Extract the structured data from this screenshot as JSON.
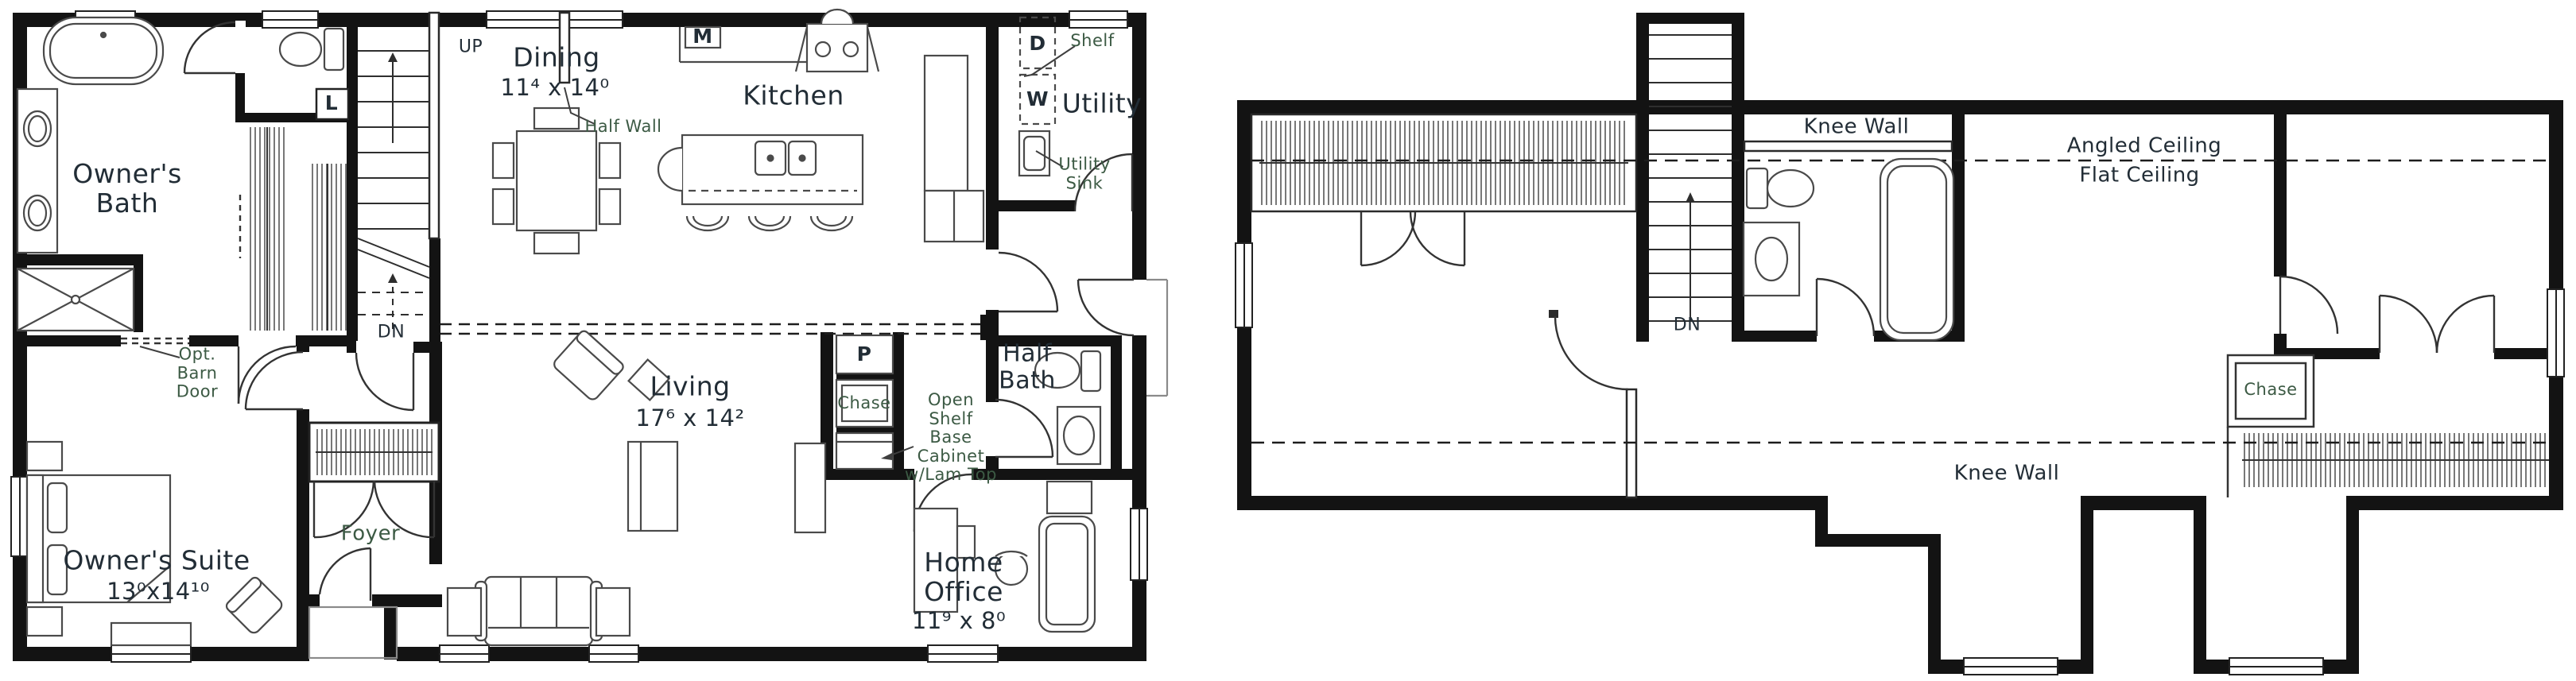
{
  "title": "Two-story house floor plan",
  "colors": {
    "wall": "#131313",
    "line": "#4a4a4a",
    "text_dark": "#222d36",
    "text_green": "#3c5a44",
    "background": "#ffffff"
  },
  "floor1": {
    "rooms": {
      "owners_bath": {
        "name": "Owner's\nBath"
      },
      "dining": {
        "name": "Dining",
        "dims": "11⁴ x 14⁰"
      },
      "kitchen": {
        "name": "Kitchen"
      },
      "utility": {
        "name": "Utility"
      },
      "living": {
        "name": "Living",
        "dims": "17⁶ x 14²"
      },
      "owners_suite": {
        "name": "Owner's Suite",
        "dims": "13⁰x14¹⁰"
      },
      "foyer": {
        "name": "Foyer"
      },
      "half_bath": {
        "name": "Half\nBath"
      },
      "home_office": {
        "name": "Home\nOffice",
        "dims": "11⁹ x 8⁰"
      }
    },
    "annotations": {
      "up": "UP",
      "dn": "DN",
      "linen": "L",
      "microwave": "M",
      "dryer": "D",
      "washer": "W",
      "pantry": "P",
      "shelf": "Shelf",
      "utility_sink": "Utility\nSink",
      "half_wall": "Half Wall",
      "opt_barn_door": "Opt.\nBarn\nDoor",
      "chase": "Chase",
      "open_shelf_cabinet": "Open\nShelf\nBase\nCabinet\nw/Lam Top"
    }
  },
  "floor2": {
    "annotations": {
      "knee_wall_top": "Knee Wall",
      "angled_ceiling": "Angled Ceiling",
      "flat_ceiling": "Flat Ceiling",
      "dn": "DN",
      "chase": "Chase",
      "knee_wall_bottom": "Knee Wall"
    }
  }
}
